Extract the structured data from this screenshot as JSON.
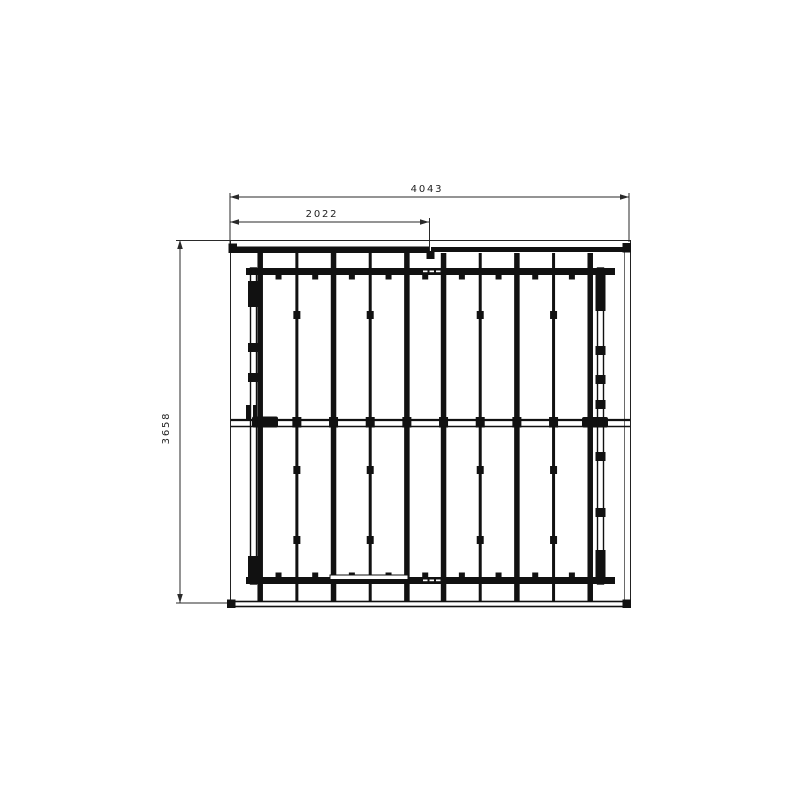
{
  "drawing": {
    "type": "technical-cad-top-view",
    "dimensions": {
      "overall_width_label": "4043",
      "half_width_label": "2022",
      "overall_height_label": "3658"
    }
  },
  "colors": {
    "background": "#ffffff",
    "ink": "#111111",
    "dim_line": "#2a2a2a",
    "frame_line": "#222222"
  },
  "diagram": {
    "geometry": {
      "bars": {
        "count": 10,
        "first_x": 260.2,
        "spacing": 36.67,
        "thin_indices": [
          1,
          3,
          6,
          8
        ],
        "top": 253,
        "bottom": 601,
        "thick_w": 5.5,
        "thin_w": 3
      },
      "knob_y": [
        311,
        466,
        536
      ],
      "top_clip_y": 274.5,
      "bottom_clip_y": 572.5,
      "mid_connector_y": 417,
      "mid_connector_h": 10.5,
      "left_rail_clips_y": [
        281,
        343,
        373,
        556
      ],
      "left_rail_clip_h": [
        26,
        9,
        9,
        28
      ],
      "right_rail_clips_y": [
        269,
        346,
        375,
        400,
        452,
        508,
        550
      ],
      "right_rail_clip_h": [
        42,
        9,
        9,
        9,
        9,
        9,
        34
      ]
    }
  }
}
